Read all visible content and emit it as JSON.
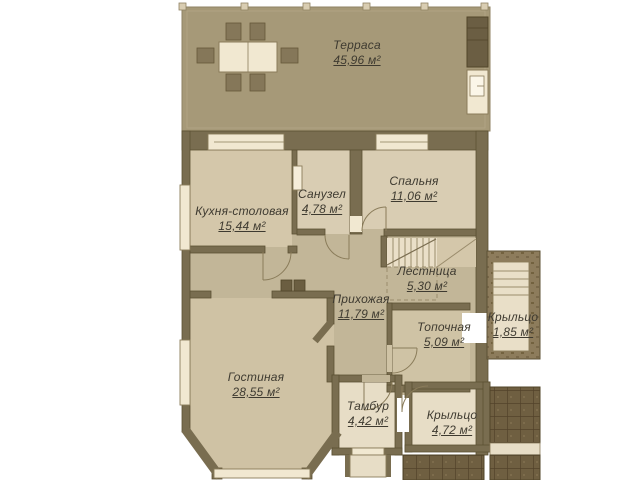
{
  "plan": {
    "type": "floor-plan",
    "units": "м²"
  },
  "rooms": [
    {
      "id": "terrace",
      "name": "Терраса",
      "area": "45,96 м²"
    },
    {
      "id": "kitchen",
      "name": "Кухня-столовая",
      "area": "15,44 м²"
    },
    {
      "id": "bathroom",
      "name": "Санузел",
      "area": "4,78 м²"
    },
    {
      "id": "bedroom",
      "name": "Спальня",
      "area": "11,06 м²"
    },
    {
      "id": "stairs",
      "name": "Лестница",
      "area": "5,30 м²"
    },
    {
      "id": "hallway",
      "name": "Прихожая",
      "area": "11,79 м²"
    },
    {
      "id": "boiler",
      "name": "Топочная",
      "area": "5,09 м²"
    },
    {
      "id": "porch-right",
      "name": "Крыльцо",
      "area": "1,85 м²"
    },
    {
      "id": "living",
      "name": "Гостиная",
      "area": "28,55 м²"
    },
    {
      "id": "vestibule",
      "name": "Тамбур",
      "area": "4,42 м²"
    },
    {
      "id": "porch-bottom",
      "name": "Крыльцо",
      "area": "4,72 м²"
    }
  ],
  "colors": {
    "background": "#ffffff",
    "terrace_floor": "#a69978",
    "room_floor": "#d4c7aa",
    "room_floor_light": "#d9cdb3",
    "hall_floor": "#c2b698",
    "living_floor": "#cfc2a4",
    "vestibule_floor": "#e7ddc6",
    "stair_floor": "#eadfc8",
    "wall": "#796d50",
    "wall_dark": "#6b5e41",
    "window_opening": "#f1e8d1",
    "porch_tile": "#6f5f41",
    "porch_stone": "#8d7c5c",
    "label_text": "#3e3a30"
  }
}
